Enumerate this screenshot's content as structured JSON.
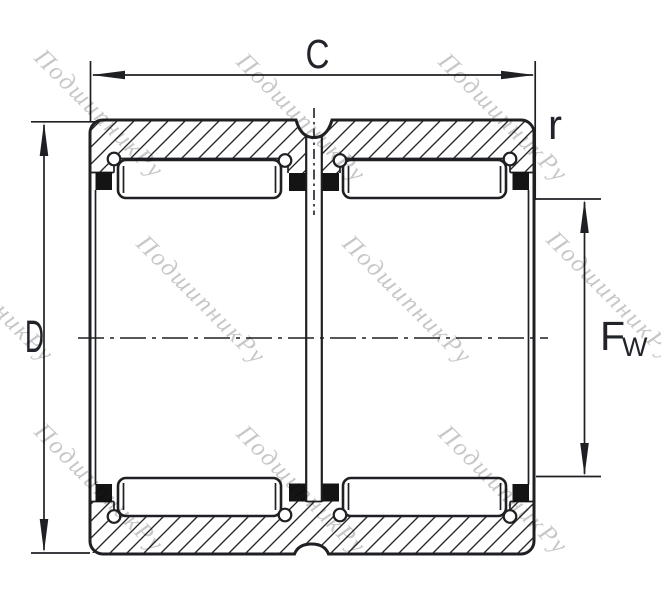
{
  "labels": {
    "width": "C",
    "outer_diameter": "D",
    "corner_radius": "r",
    "bore_main": "F",
    "bore_sub": "W"
  },
  "watermark": {
    "text": "ПодшипникРу"
  },
  "colors": {
    "background": "#ffffff",
    "line": "#1f2024",
    "label": "#22242b",
    "hatch": "#27272a",
    "cage_fill": "#141414",
    "watermark": "#c7c7c7"
  }
}
